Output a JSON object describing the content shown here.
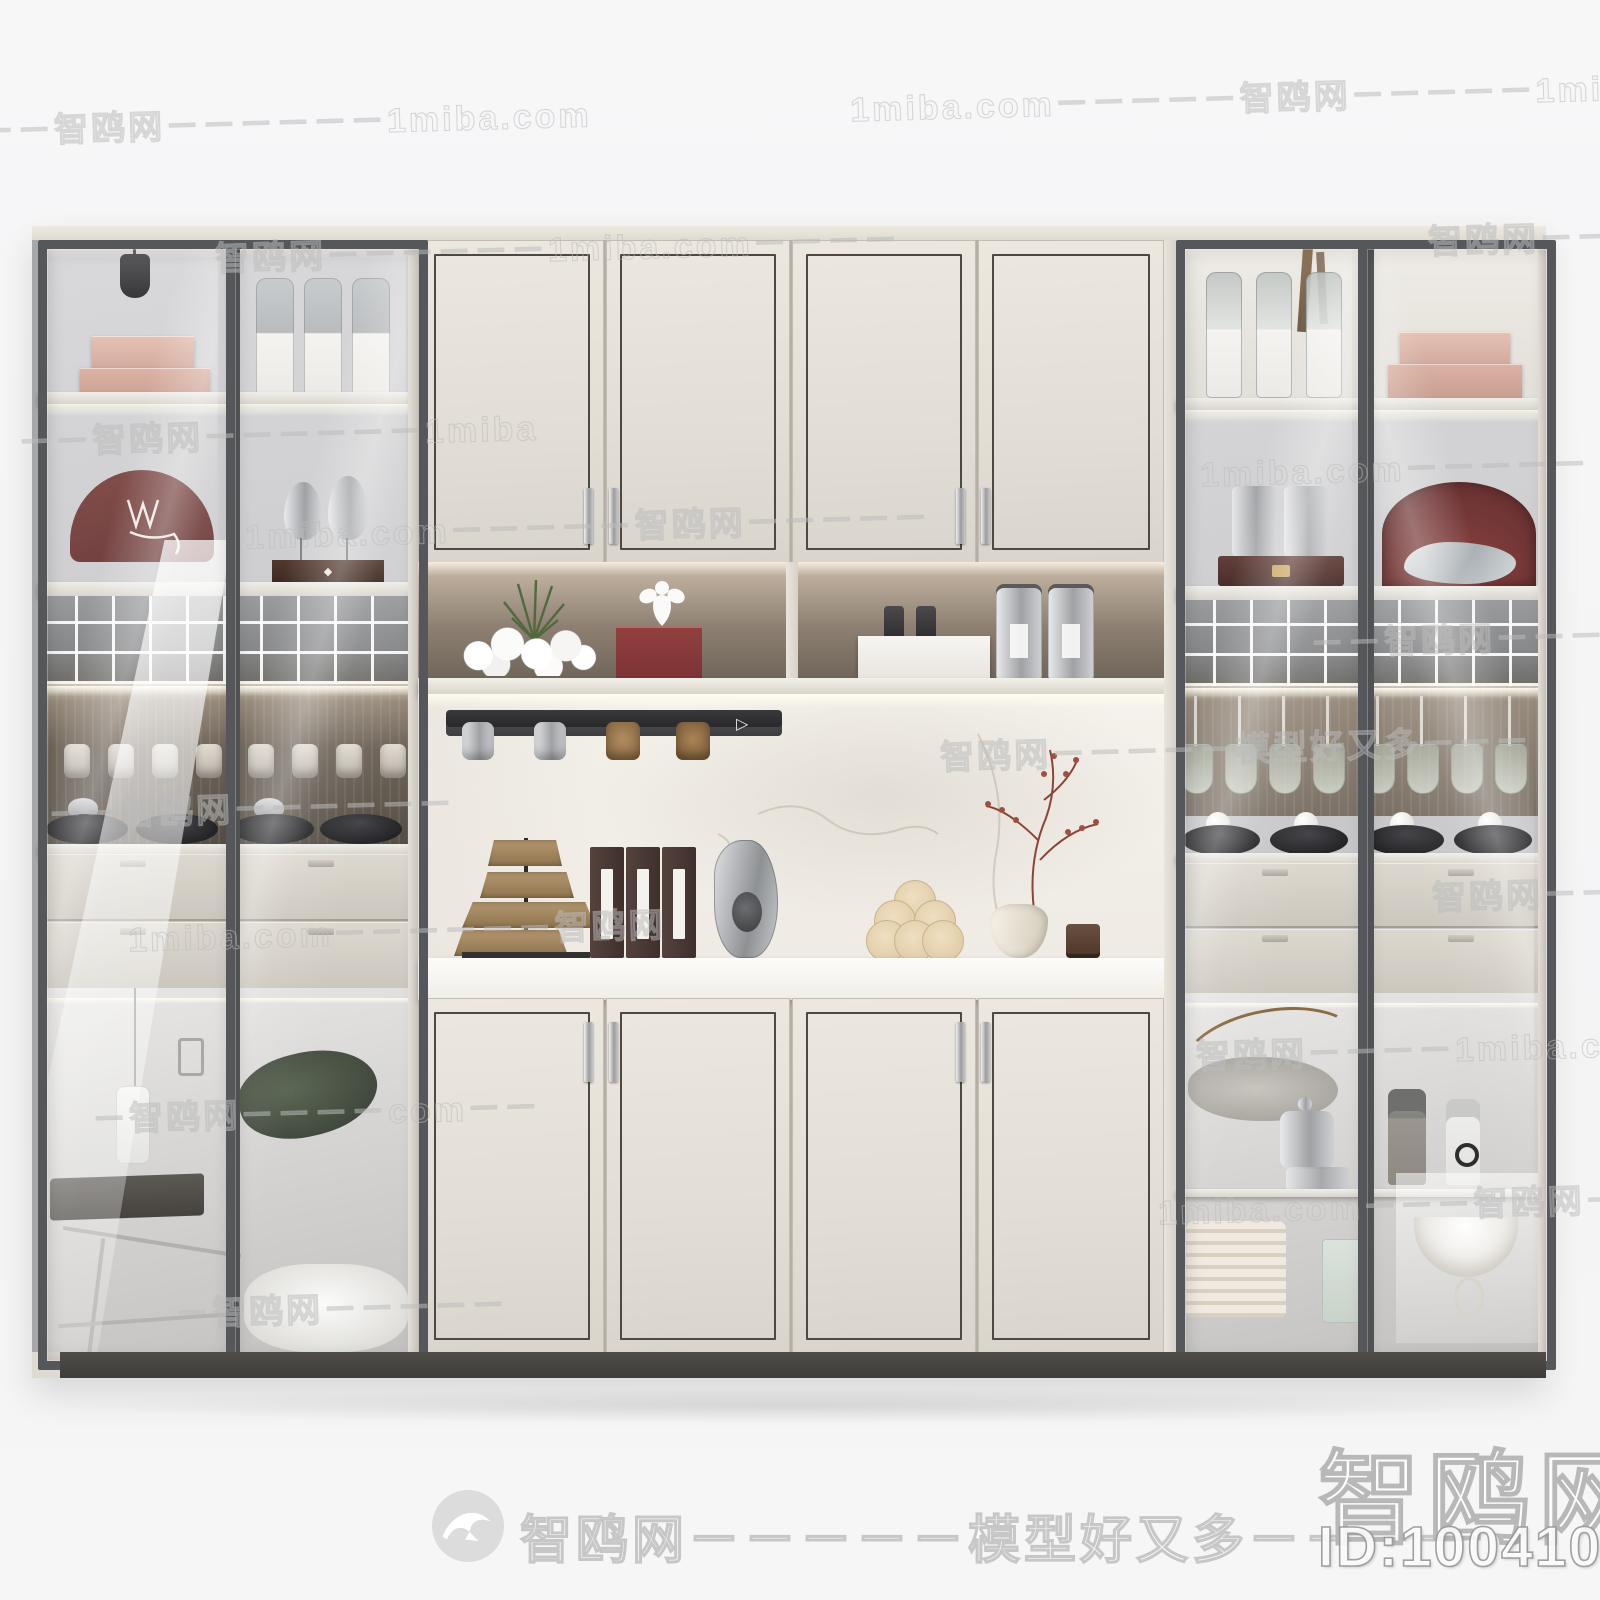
{
  "watermarks": {
    "brand": "智鸥网",
    "site": "1miba.com",
    "slogan": "模型好又多",
    "footer_text": "智鸥网－－－－－模型好又多－－－－",
    "corner_brand": "智鸥网",
    "corner_id": "ID:100410062",
    "logo_icon": "seagull-logo",
    "tiles": [
      {
        "text": "－－智鸥网－－－－－－1miba.com"
      },
      {
        "text": "1miba.com－－－－－智鸥网－－－－－1miba.com"
      },
      {
        "text": "智鸥网－－－－－－1miba.com－－－－"
      },
      {
        "text": "智鸥网－－"
      },
      {
        "text": "－－智鸥网－－－－－－1miba"
      },
      {
        "text": "1miba.com－－－－－"
      },
      {
        "text": "1miba.com－－－－－智鸥网－－－－－"
      },
      {
        "text": "－－智鸥网－－－－"
      },
      {
        "text": "－－智鸥网－－－－－－"
      },
      {
        "text": "智鸥网－－－－－模型好又多－－－"
      },
      {
        "text": "1miba.com－－－－－－智鸥网"
      },
      {
        "text": "智鸥网－－"
      },
      {
        "text": "智鸥网－－－－1miba.com－－"
      },
      {
        "text": "－智鸥网－－－－com－－"
      },
      {
        "text": "1miba.com－－－智鸥网－－－"
      },
      {
        "text": "－智鸥网－－－－－"
      }
    ]
  },
  "icons": {
    "play_glyph": "▷",
    "diamond_glyph": "◆"
  },
  "scene": {
    "colors": {
      "background": "#f6f6f7",
      "cabinet_cream": "#e2ddd5",
      "glass_frame": "#55575a",
      "niche_back": "#8d8072",
      "plinth": "#454341",
      "accent_red": "#8a3a3c",
      "accent_pink": "#d9b3a8",
      "watermark_gray": "#bcbcbc"
    }
  }
}
